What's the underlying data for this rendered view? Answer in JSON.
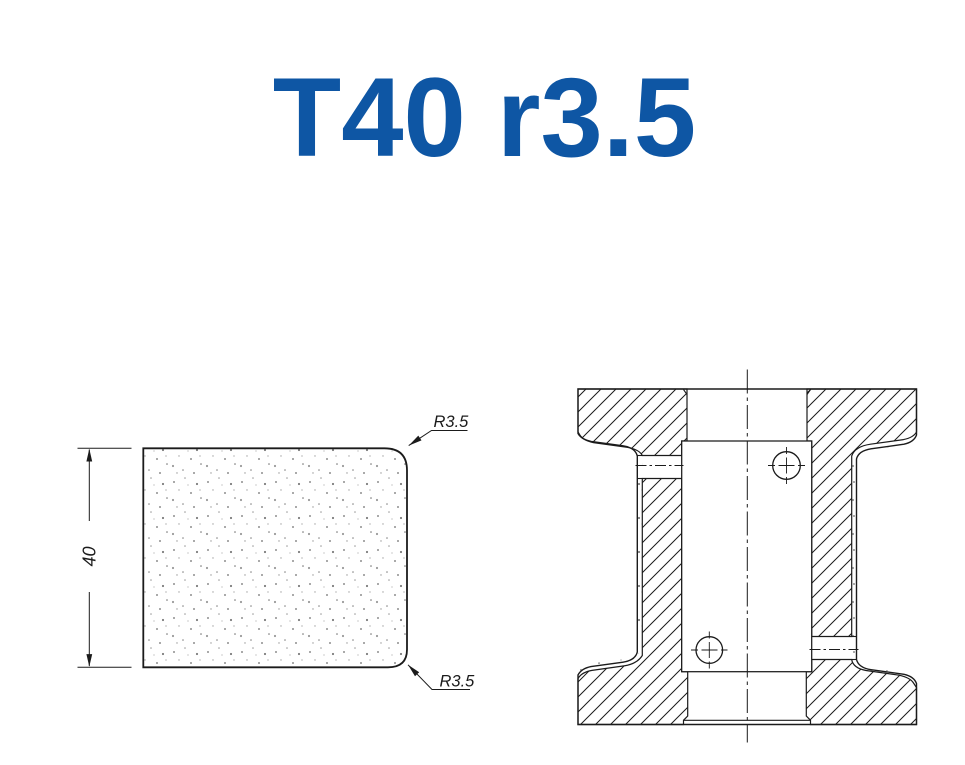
{
  "title": {
    "text": "T40 r3.5",
    "color": "#0E56A4"
  },
  "profile_view": {
    "height_dimension_label": "40",
    "top_radius_label": "R3.5",
    "bottom_radius_label": "R3.5"
  },
  "colors": {
    "line": "#1b1b1b",
    "background": "#ffffff",
    "title_blue": "#0E56A4",
    "stipple": "#8f8f8f"
  }
}
